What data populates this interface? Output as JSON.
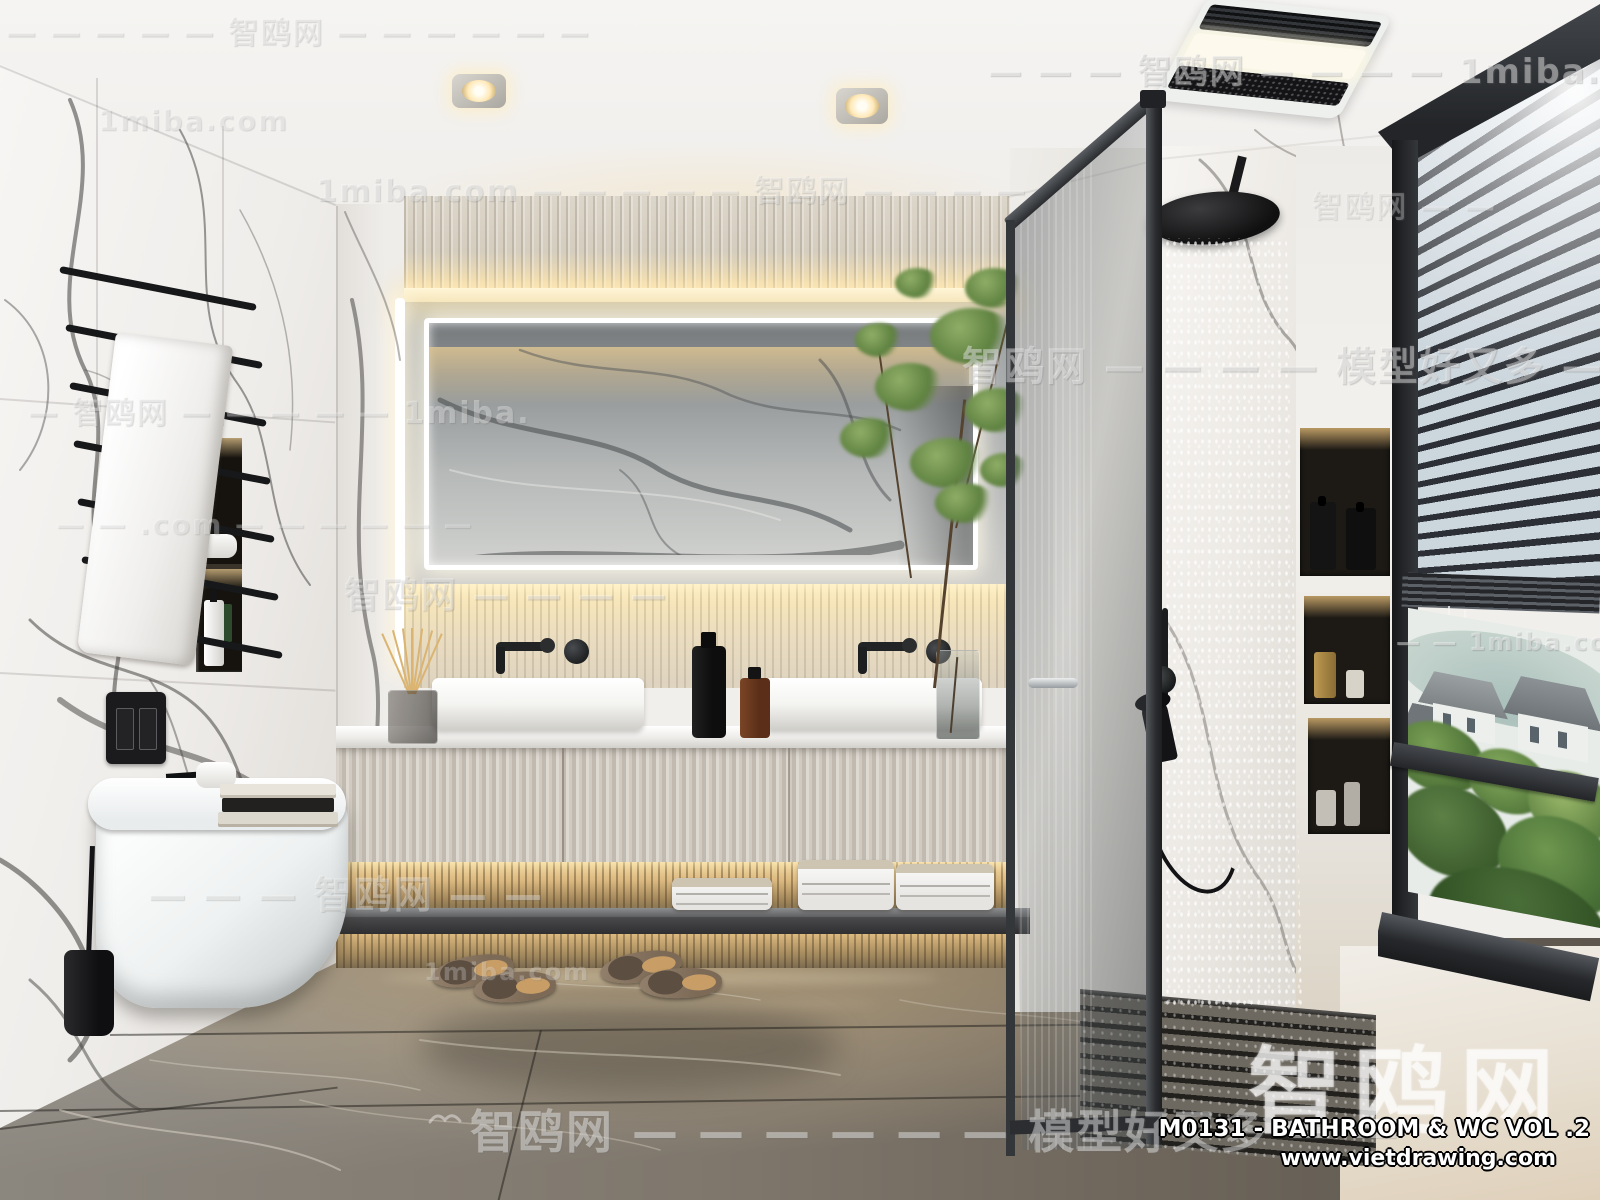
{
  "scene": {
    "description": "Photorealistic 3D render of a modern marble bathroom: double fluted vanity with LED mirror, wall-hung toilet, black fixtures, walk-in rain shower behind tinted glass, and a blinded window overlooking greenery"
  },
  "watermarks": {
    "brand_cn": "智鸥网",
    "site": "1miba.com",
    "slogan": "模型好又多",
    "bands": [
      {
        "text": "— — — — — 智鸥网 — — — — — —"
      },
      {
        "text": "— — — 智鸥网 — — — — 1miba."
      },
      {
        "text": "1miba.com — — — — — 智鸥网 — — — —"
      },
      {
        "text": "智鸥网 — — — — 模型好又多 — —"
      },
      {
        "text": "— 智鸥网 — — — — — 1miba."
      },
      {
        "text": "— — .com — — — — — —"
      },
      {
        "text": "智鸥网 — — — —"
      },
      {
        "text": "— — — 智鸥网 — —"
      },
      {
        "text": "— — 1miba.com"
      },
      {
        "text": "智鸥网 — — — — — — 模型好又多 — —"
      },
      {
        "text": "智鸥网 — —"
      }
    ]
  },
  "credits": {
    "brand": "智鸥网",
    "model": "M0131 - BATHROOM & WC VOL .2",
    "website": "www.vietdrawing.com"
  },
  "palette": {
    "marble_white": "#f2f0ec",
    "marble_vein": "#3a3836",
    "warm_glow": "#ffeec6",
    "grey_wall": "#a7abac",
    "floor_brown": "#7f776c",
    "fixture_black": "#1b1c1e",
    "cabinet_flute": "#d6d1c8",
    "glass_tint": "#3c4246",
    "greenery": "#6b8f4b"
  }
}
